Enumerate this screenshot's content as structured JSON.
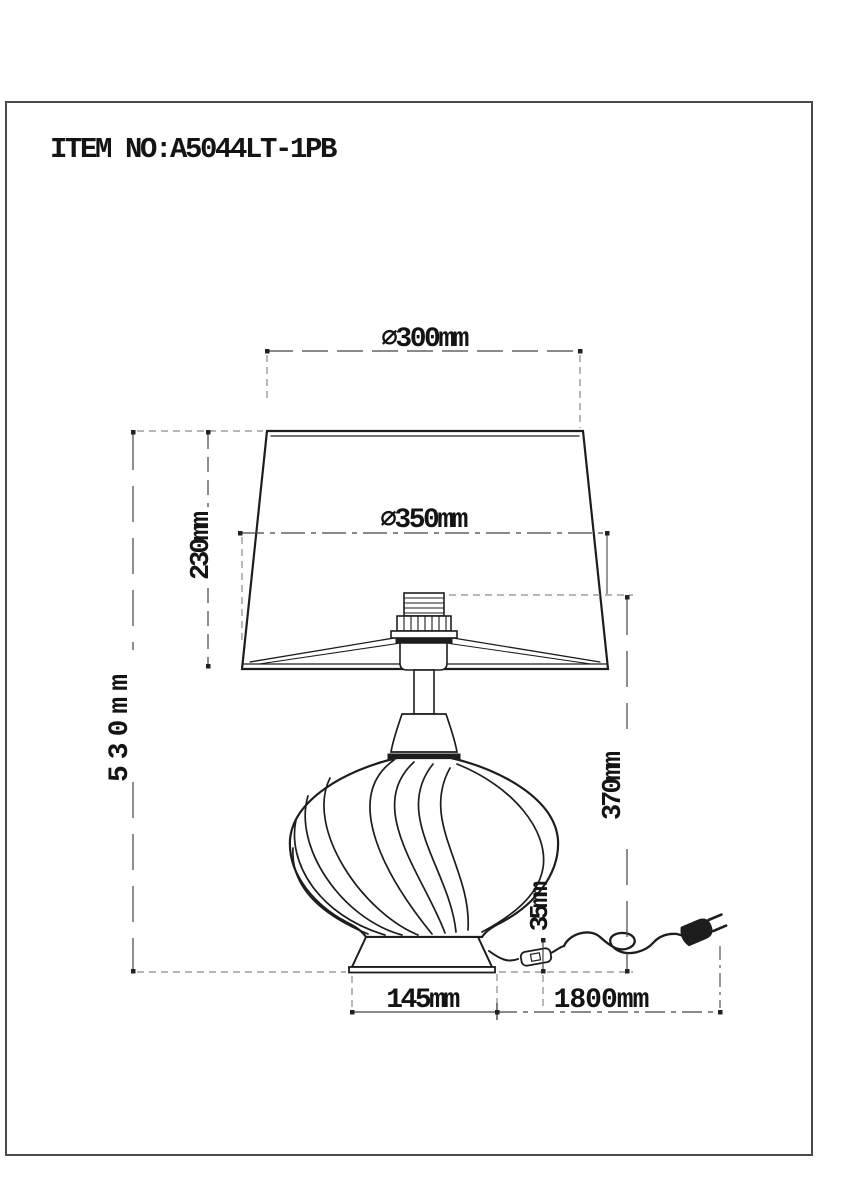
{
  "document": {
    "item_label": "ITEM NO:A5044LT-1PB",
    "type": "table-lamp technical dimension drawing"
  },
  "drawing": {
    "dimensions": {
      "shade_top_diameter": "⌀300mm",
      "shade_bottom_diameter": "⌀350mm",
      "shade_height": "230mm",
      "total_height": "530mm",
      "socket_height": "370mm",
      "switch_height": "35mm",
      "base_width": "145mm",
      "cord_length": "1800mm"
    },
    "colors": {
      "line": "#1d1d1d",
      "dimension": "#444444",
      "extension": "#8a8a8a",
      "background": "#ffffff",
      "border": "#4a4a4a"
    }
  }
}
